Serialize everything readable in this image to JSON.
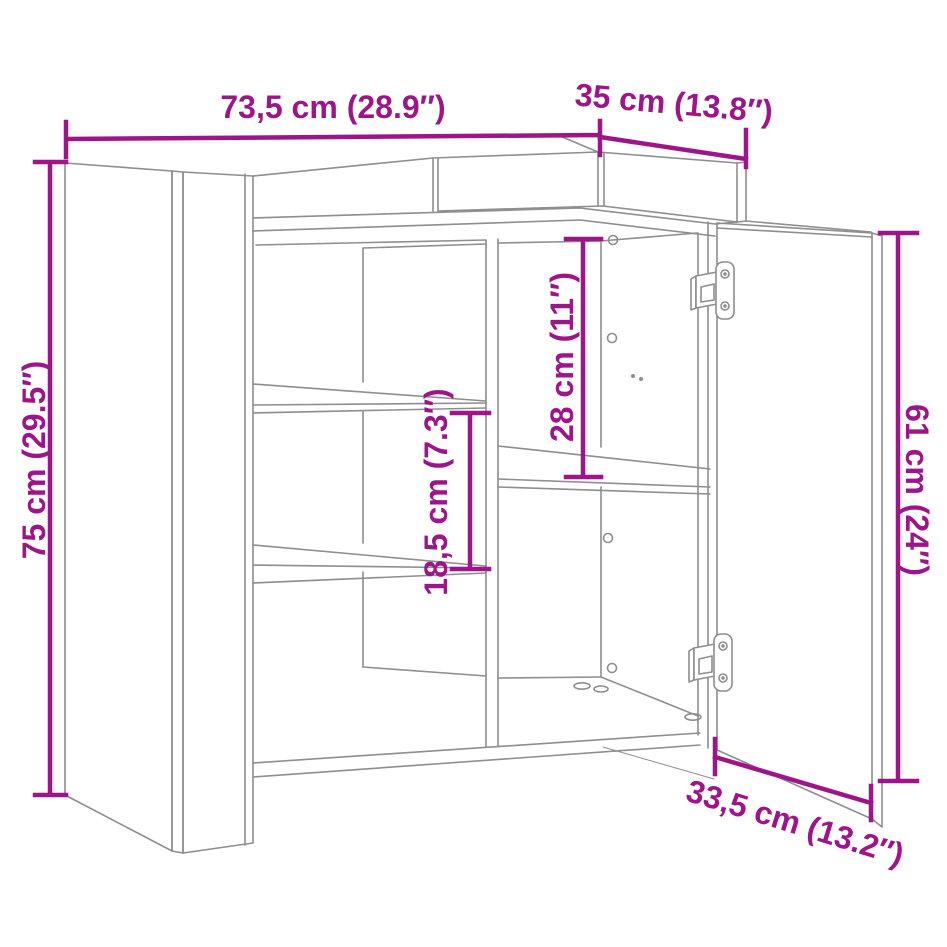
{
  "diagram": {
    "subject": "sideboard line drawing with open right door, two left shelves, middle divider and raised back rail",
    "style": {
      "annotation_color": "#9D1588",
      "outline_color": "#8E8E8E",
      "background_color": "#FFFFFF"
    },
    "annotations": {
      "overall_width": {
        "label": "73,5 cm (28.9″)"
      },
      "overall_depth": {
        "label": "35 cm (13.8″)"
      },
      "overall_height": {
        "label": "75 cm (29.5″)"
      },
      "shelf_spacing": {
        "label": "18,5 cm (7.3″)"
      },
      "upper_compartment_height": {
        "label": "28 cm (11″)"
      },
      "door_height": {
        "label": "61 cm (24″)"
      },
      "door_width": {
        "label": "33,5 cm (13.2″)"
      }
    }
  }
}
